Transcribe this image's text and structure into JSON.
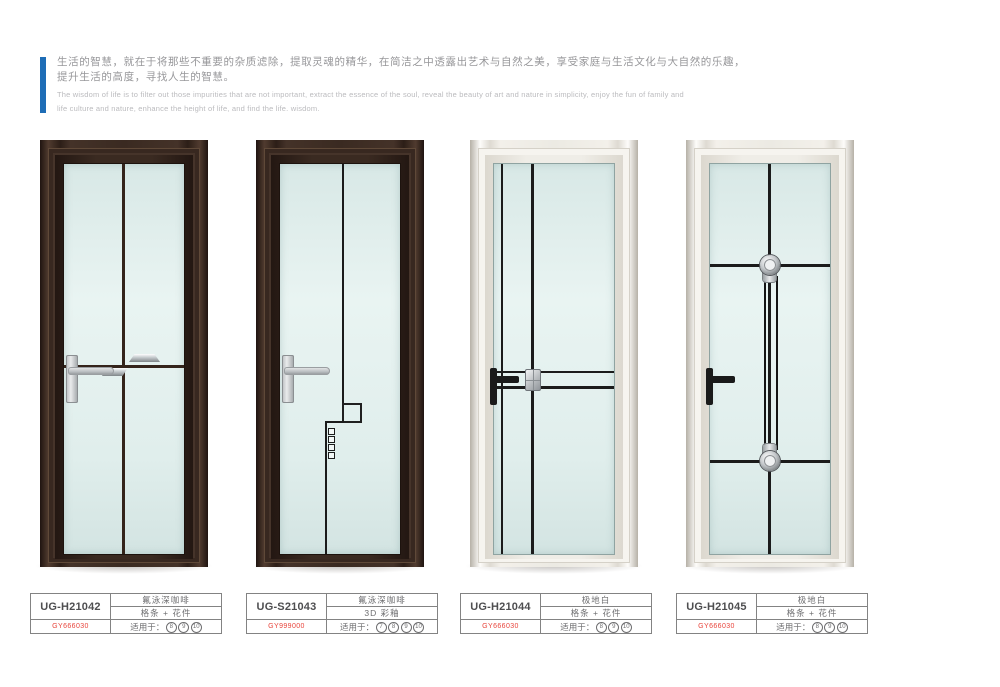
{
  "intro": {
    "accent_color": "#1e6db6",
    "cn_line1": "生活的智慧，就在于将那些不重要的杂质滤除，提取灵魂的精华，在简洁之中透露出艺术与自然之美，享受家庭与生活文化与大自然的乐趣，",
    "cn_line2": "提升生活的高度，寻找人生的智慧。",
    "en_line1": "The wisdom of life is to filter out those impurities that are not important, extract the essence of the soul, reveal the beauty of art and nature in simplicity, enjoy the fun of family and",
    "en_line2": "life culture and nature, enhance the height of life, and find the life. wisdom."
  },
  "labels": {
    "applicable_prefix": "适用于："
  },
  "products": [
    {
      "model": "UG-H21042",
      "finish": "氟泳深咖啡",
      "craft": "格条 + 花件",
      "code": "GY666030",
      "applicable": [
        "8",
        "9",
        "10"
      ],
      "frame": "dark-brown"
    },
    {
      "model": "UG-S21043",
      "finish": "氟泳深咖啡",
      "craft": "3D 彩釉",
      "code": "GY999000",
      "applicable": [
        "7",
        "8",
        "9",
        "10"
      ],
      "frame": "dark-brown"
    },
    {
      "model": "UG-H21044",
      "finish": "极地白",
      "craft": "格条 + 花件",
      "code": "GY666030",
      "applicable": [
        "8",
        "9",
        "10"
      ],
      "frame": "polar-white"
    },
    {
      "model": "UG-H21045",
      "finish": "极地白",
      "craft": "格条 + 花件",
      "code": "GY666030",
      "applicable": [
        "8",
        "9",
        "10"
      ],
      "frame": "polar-white"
    }
  ],
  "colors": {
    "accent_blue": "#1e6db6",
    "code_red": "#e8453c",
    "body_text_gray": "#97979a",
    "frame_dark_brown": "#3a2a21",
    "frame_white": "#f3f0ea",
    "glass_tint": "#e0eeec",
    "grid_black": "#1b1b1b"
  }
}
